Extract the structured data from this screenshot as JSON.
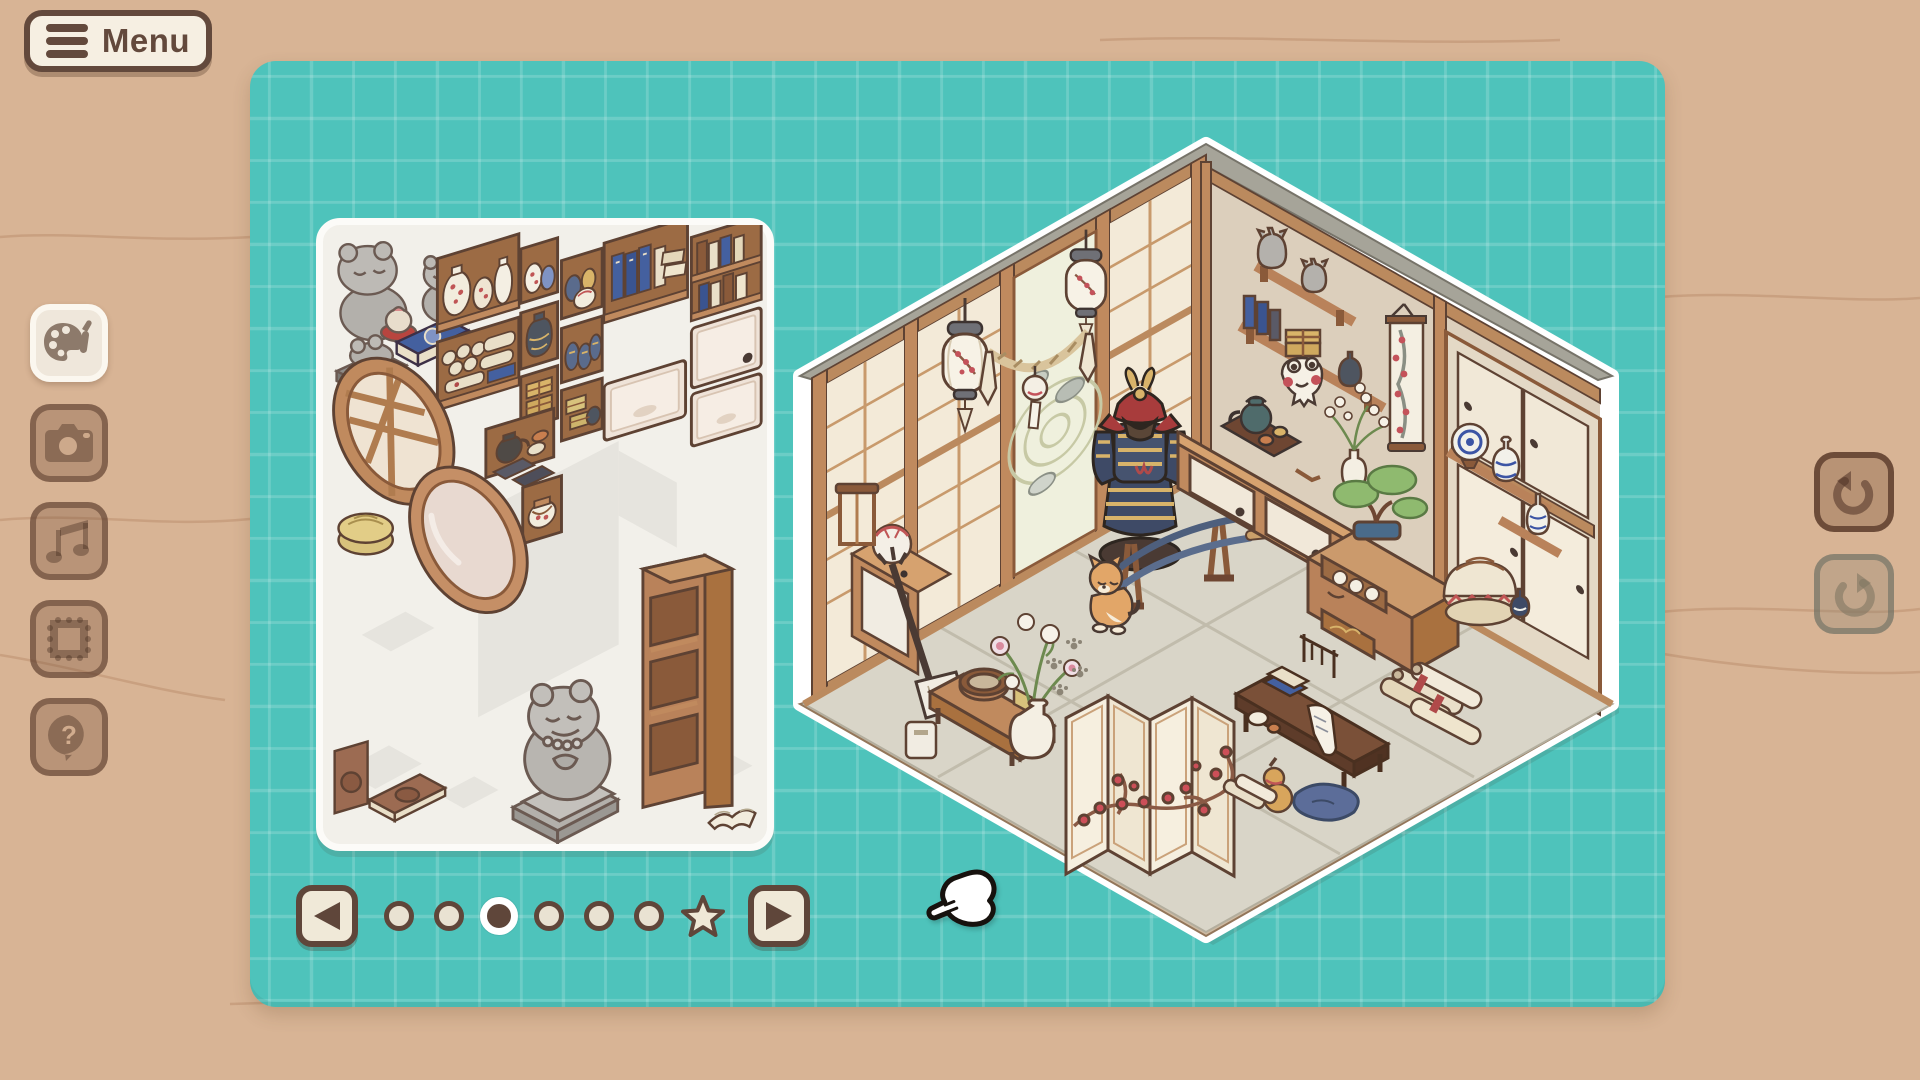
{
  "menu": {
    "label": "Menu",
    "icon": "hamburger-icon"
  },
  "left_toolbar": {
    "items": [
      {
        "id": "decorate",
        "icon": "palette-brush-icon",
        "active": true
      },
      {
        "id": "photo",
        "icon": "camera-icon",
        "active": false
      },
      {
        "id": "music",
        "icon": "music-note-icon",
        "active": false
      },
      {
        "id": "frame",
        "icon": "frame-icon",
        "active": false
      },
      {
        "id": "help",
        "icon": "question-bubble-icon",
        "active": false,
        "glyph": "?"
      }
    ]
  },
  "right_toolbar": {
    "items": [
      {
        "id": "undo",
        "icon": "undo-arrow-icon",
        "enabled": true
      },
      {
        "id": "redo",
        "icon": "redo-arrow-icon",
        "enabled": false
      }
    ]
  },
  "board": {
    "grid": "on",
    "colors": {
      "background": "#d8b495",
      "surface": "#4ec3bb",
      "grid_line": "#63cdc6",
      "cream": "#f0e9d8",
      "dark_brown": "#5f463a"
    }
  },
  "inventory_panel": {
    "pages": {
      "current": 3,
      "indicators": [
        "page",
        "page",
        "page-current",
        "page",
        "page",
        "page",
        "star"
      ],
      "prev": "left-arrow",
      "next": "right-arrow"
    },
    "items": [
      "frog monk statue",
      "small frog statue",
      "blue book",
      "frog on pedestal",
      "round lattice window",
      "oval mirror",
      "straw coaster",
      "shelf with plum vases",
      "shelf with scrolls",
      "shelf with vases",
      "shelf with dark jar",
      "shelf with gold boxes",
      "shelf with sake jars",
      "shelf with blue jars",
      "shelf with crates",
      "shelf with blue books",
      "shelf with teapot",
      "small dark books",
      "shelf with pot",
      "bookshelf with books",
      "cream drawer",
      "cream drawer",
      "cream drawer",
      "brown book",
      "flat brown book",
      "frog buddha statue",
      "tall empty bookshelf",
      "open book"
    ]
  },
  "room": {
    "shape": "hexagon",
    "theme": "japanese tatami room",
    "items": [
      "paper lantern",
      "paper lantern",
      "shimenawa rope",
      "wind chime",
      "shoji wall",
      "zen garden doorway",
      "samurai armor",
      "katana stand",
      "wall shelves with figurines",
      "hanging plum scroll",
      "frog mask",
      "sideboard with sliding doors",
      "teapot tray",
      "blossom vase",
      "bonsai on tansu chest",
      "tansu chest with teacups",
      "porcelain shelf",
      "striped basket with sake bottle",
      "sliding door cabinet",
      "shiba inu",
      "paw prints",
      "peony vase",
      "bench with tub basket",
      "shamisen",
      "drum cabinet",
      "folding screen with plum",
      "writing desk",
      "blue cushion",
      "floor scrolls",
      "gourd"
    ]
  },
  "cursor": {
    "type": "hand-pointer"
  }
}
